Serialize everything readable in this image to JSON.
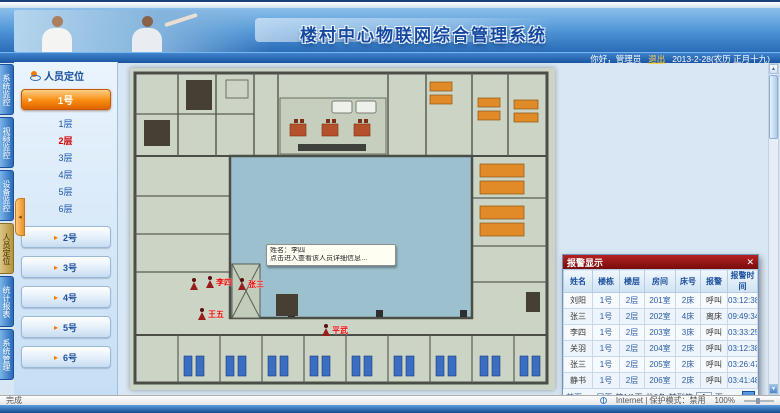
{
  "header": {
    "title": "楼村中心物联网综合管理系统",
    "greeting": "你好，管理员",
    "logout": "退出",
    "date": "2013-2-28(农历 正月十九)"
  },
  "sidebar": {
    "tabs": [
      {
        "label": "系统监控"
      },
      {
        "label": "视频监控"
      },
      {
        "label": "设备监控"
      },
      {
        "label": "人员定位"
      },
      {
        "label": "统计报表"
      },
      {
        "label": "系统管理"
      }
    ],
    "panel_title": "人员定位",
    "selected_building": "1号",
    "floors": [
      {
        "label": "1层"
      },
      {
        "label": "2层"
      },
      {
        "label": "3层"
      },
      {
        "label": "4层"
      },
      {
        "label": "5层"
      },
      {
        "label": "6层"
      }
    ],
    "buildings": [
      "2号",
      "3号",
      "4号",
      "5号",
      "6号"
    ],
    "collapse_arrow": "◂"
  },
  "floorplan": {
    "persons": [
      {
        "name": ""
      },
      {
        "name": "李四"
      },
      {
        "name": "张三"
      },
      {
        "name": "王五"
      },
      {
        "name": "平武"
      }
    ],
    "tooltip": {
      "line1": "姓名：李四",
      "line2": "点击进入查看该人员详细信息…"
    }
  },
  "alarm_popup": {
    "title": "报警显示",
    "close": "✕",
    "columns": [
      "姓名",
      "楼栋",
      "楼层",
      "房间",
      "床号",
      "报警",
      "报警时间"
    ],
    "rows": [
      [
        "刘阳",
        "1号",
        "2层",
        "201室",
        "2床",
        "呼叫",
        "03:12:38"
      ],
      [
        "张三",
        "1号",
        "2层",
        "202室",
        "4床",
        "离床",
        "09:49:34"
      ],
      [
        "李四",
        "1号",
        "2层",
        "203室",
        "3床",
        "呼叫",
        "03:33:25"
      ],
      [
        "关羽",
        "1号",
        "2层",
        "204室",
        "2床",
        "呼叫",
        "03:12:38"
      ],
      [
        "张三",
        "1号",
        "2层",
        "205室",
        "2床",
        "呼叫",
        "03:26:47"
      ],
      [
        "静书",
        "1号",
        "2层",
        "206室",
        "2床",
        "呼叫",
        "03:41:48"
      ]
    ],
    "pagination": {
      "first": "首页",
      "prev": "‹",
      "next": "›",
      "last": "尾页",
      "info": "第1/1页",
      "total": "共6条",
      "goto": "转到第",
      "page": "1",
      "unit": "页",
      "go": "»"
    }
  },
  "statusbar": {
    "status": "完成",
    "zone": "Internet | 保护模式：禁用",
    "zoom": "100%"
  },
  "colors": {
    "accent_orange": "#f57900",
    "header_blue": "#2a6cb8",
    "alarm_title_red": "#8a1010",
    "courtyard_blue": "#9cc0ce",
    "active_floor_red": "#d40000"
  }
}
